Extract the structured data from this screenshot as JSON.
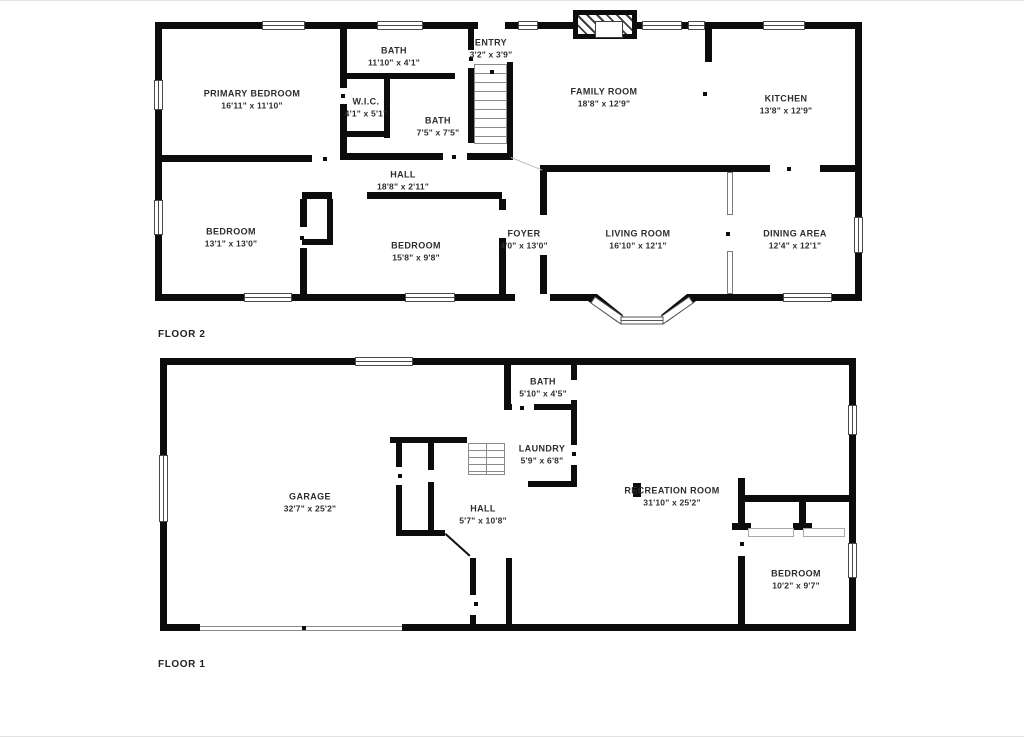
{
  "page": {
    "wall_color": "#0c0c0c",
    "label_color": "#2d2d2d",
    "background": "#ffffff"
  },
  "floor2": {
    "label": "FLOOR 2",
    "rooms": [
      {
        "name": "PRIMARY BEDROOM",
        "dims": "16'11\" x 11'10\""
      },
      {
        "name": "BATH",
        "dims": "11'10\" x 4'1\""
      },
      {
        "name": "W.I.C.",
        "dims": "4'1\" x 5'1\""
      },
      {
        "name": "BATH",
        "dims": "7'5\" x 7'5\""
      },
      {
        "name": "ENTRY",
        "dims": "3'2\" x 3'9\""
      },
      {
        "name": "FAMILY ROOM",
        "dims": "18'8\" x 12'9\""
      },
      {
        "name": "KITCHEN",
        "dims": "13'8\" x 12'9\""
      },
      {
        "name": "HALL",
        "dims": "18'8\" x 2'11\""
      },
      {
        "name": "BEDROOM",
        "dims": "13'1\" x 13'0\""
      },
      {
        "name": "BEDROOM",
        "dims": "15'8\" x 9'8\""
      },
      {
        "name": "FOYER",
        "dims": "4'0\" x 13'0\""
      },
      {
        "name": "LIVING ROOM",
        "dims": "16'10\" x 12'1\""
      },
      {
        "name": "DINING AREA",
        "dims": "12'4\" x 12'1\""
      }
    ]
  },
  "floor1": {
    "label": "FLOOR 1",
    "rooms": [
      {
        "name": "GARAGE",
        "dims": "32'7\" x 25'2\""
      },
      {
        "name": "BATH",
        "dims": "5'10\" x 4'5\""
      },
      {
        "name": "LAUNDRY",
        "dims": "5'9\" x 6'8\""
      },
      {
        "name": "HALL",
        "dims": "5'7\" x 10'8\""
      },
      {
        "name": "RECREATION ROOM",
        "dims": "31'10\" x 25'2\""
      },
      {
        "name": "BEDROOM",
        "dims": "10'2\" x 9'7\""
      }
    ]
  }
}
